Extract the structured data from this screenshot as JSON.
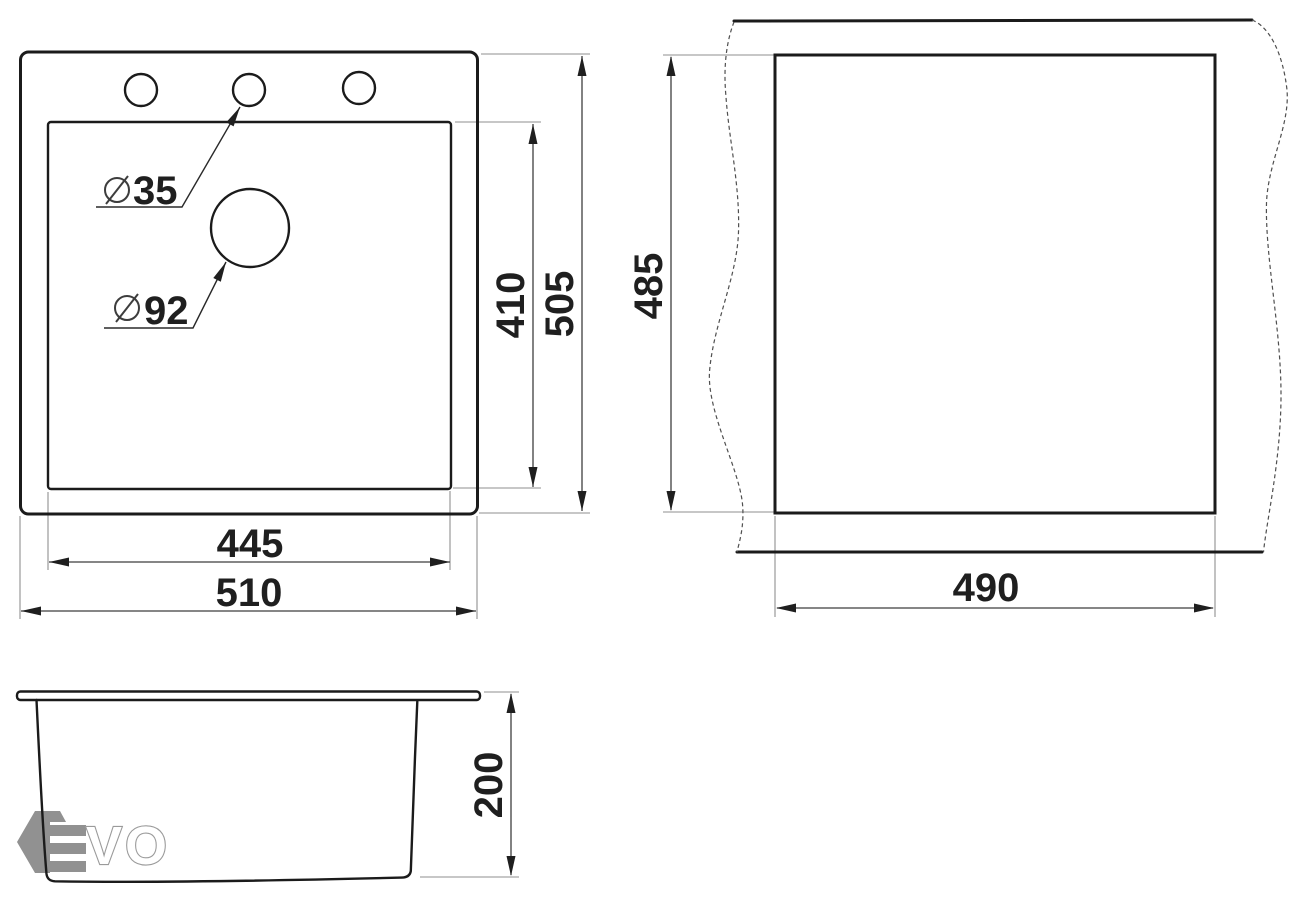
{
  "top_view": {
    "faucet_hole_label": "35",
    "main_hole_label": "92",
    "bowl_length": "410",
    "overall_length": "505",
    "bowl_width": "445",
    "overall_width": "510"
  },
  "cutout_view": {
    "cutout_length": "485",
    "cutout_width": "490"
  },
  "front_view": {
    "depth": "200"
  },
  "watermark": {
    "brand": "EVO",
    "text_outline": "VO",
    "color": "#919191"
  },
  "colors": {
    "drawing_line": "#1b1b1b",
    "dimension_line": "#3f3f3f",
    "extension_line": "#8f8f8f",
    "background": "#ffffff"
  }
}
